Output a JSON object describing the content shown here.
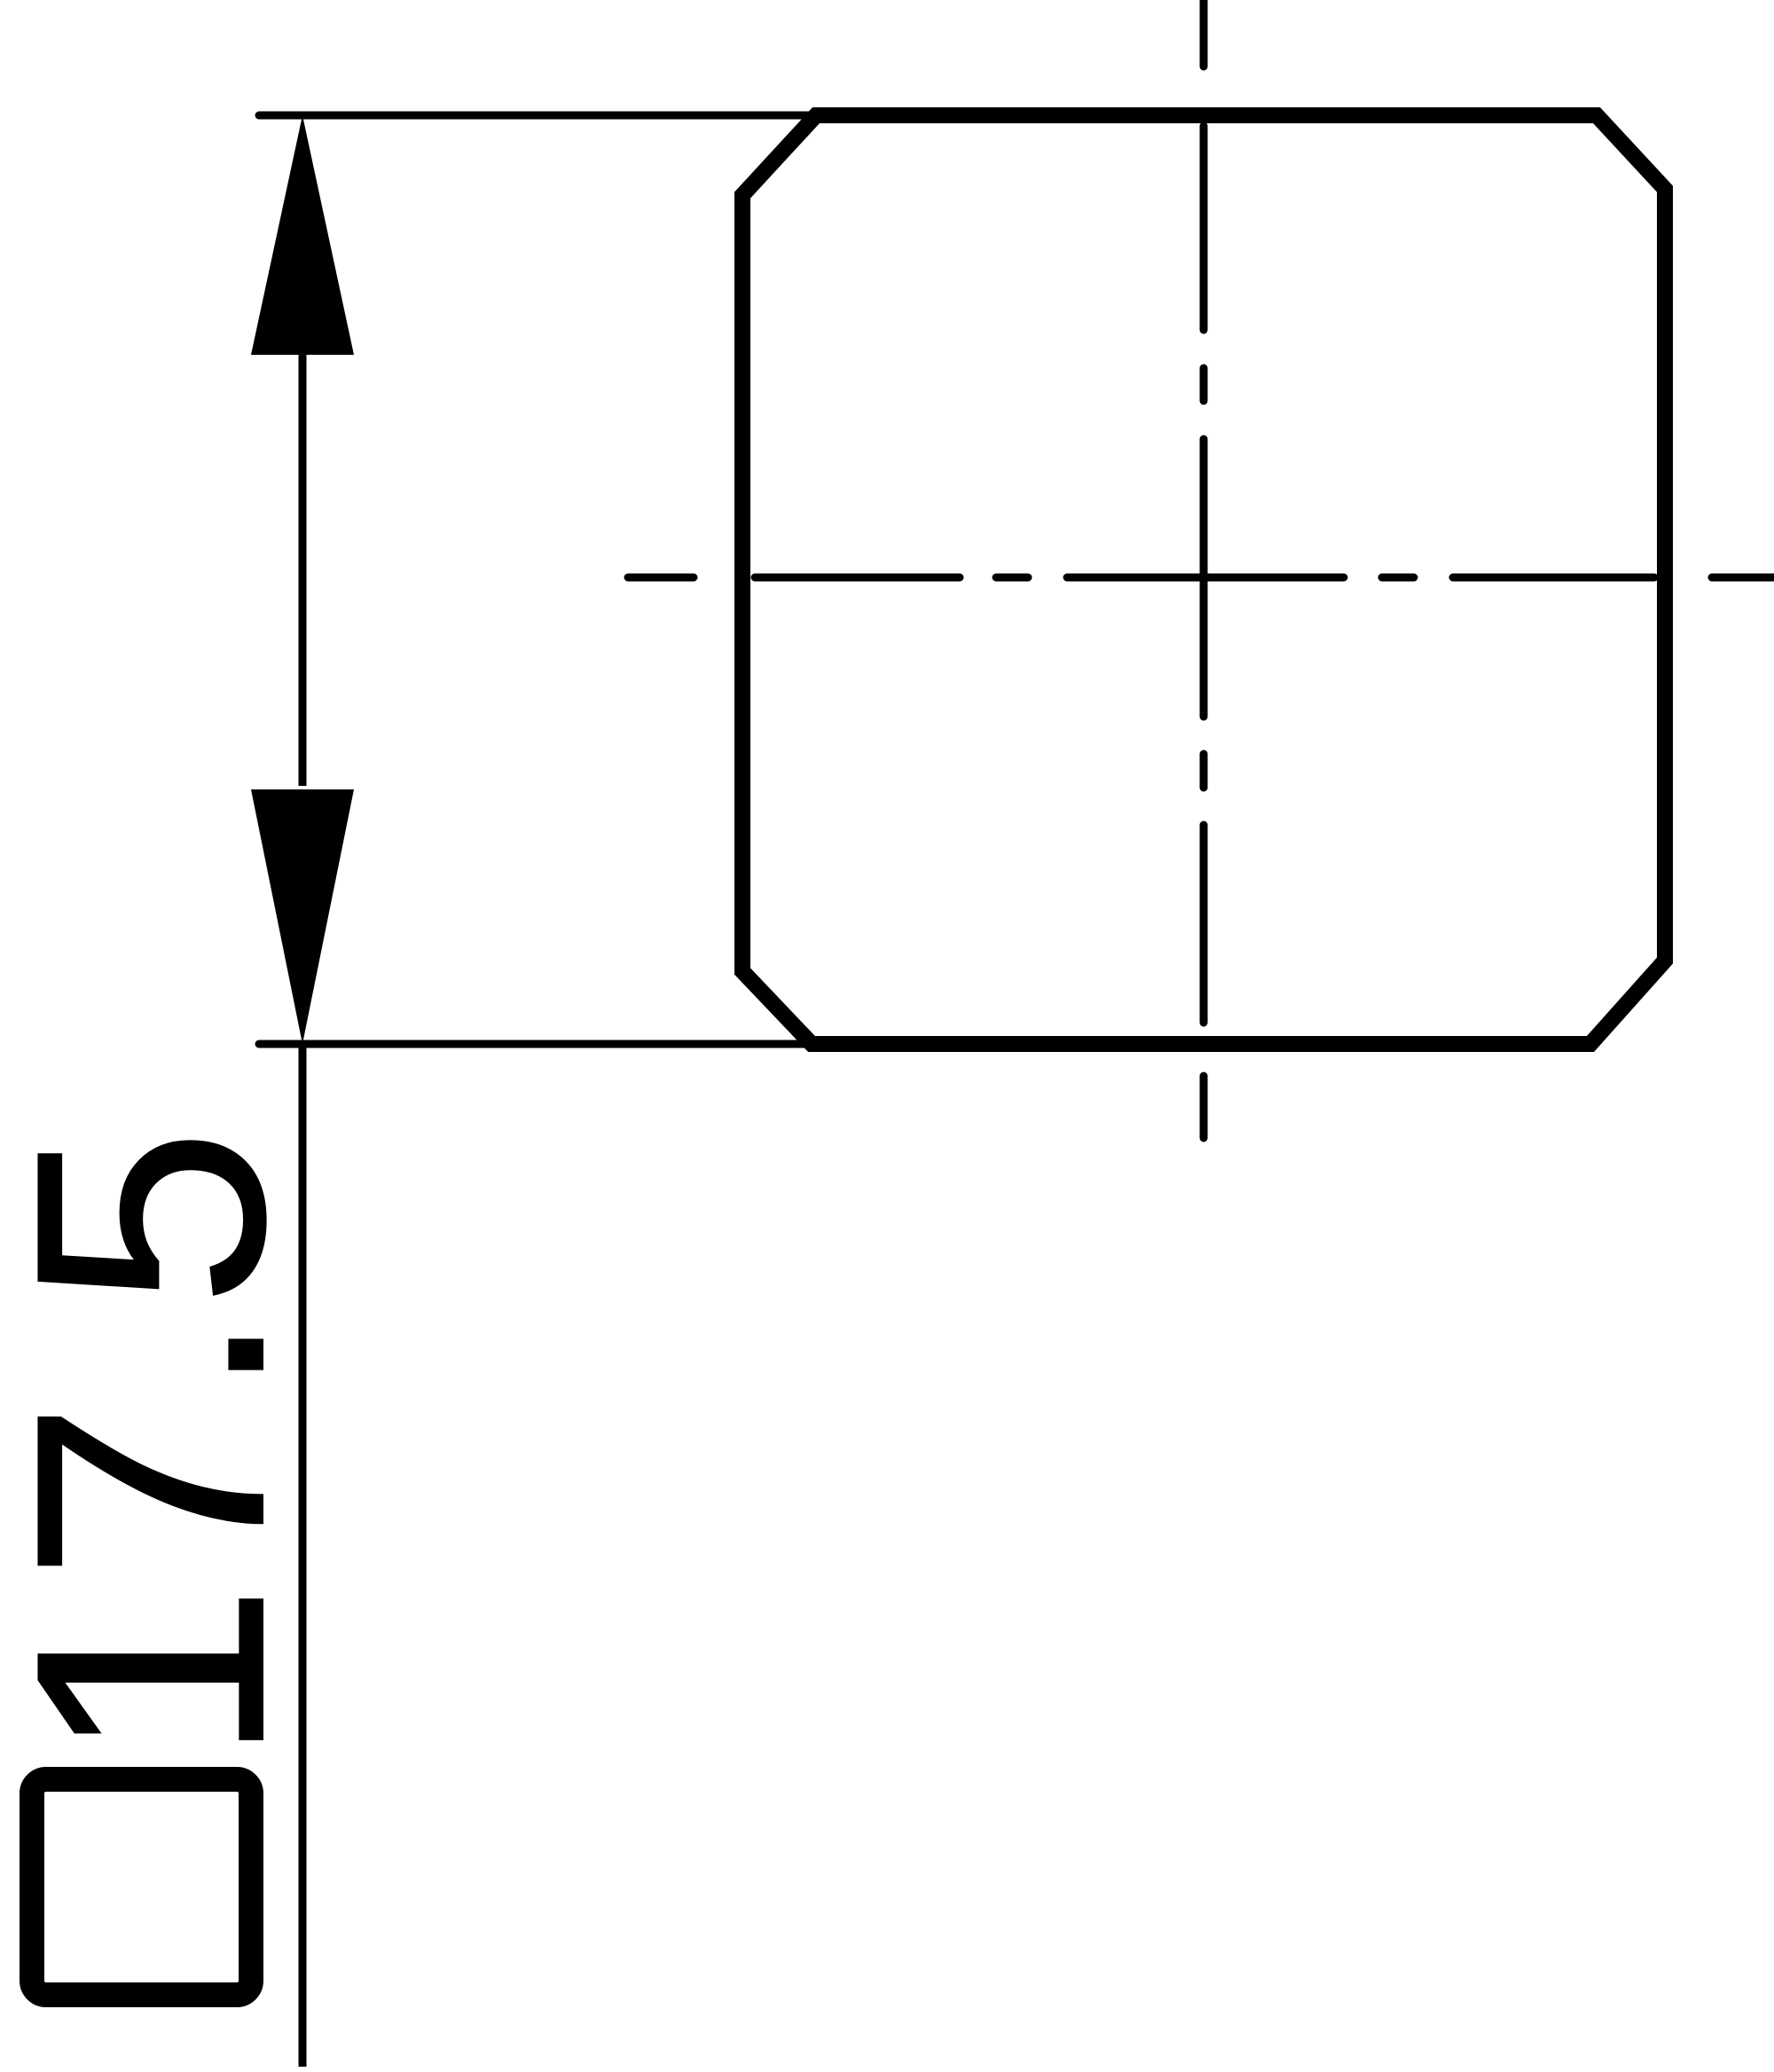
{
  "drawing": {
    "dimension": {
      "value": "17.5",
      "square_symbol": "□",
      "full_label": "□17.5"
    },
    "colors": {
      "line": "#000000",
      "background": "#ffffff"
    }
  }
}
